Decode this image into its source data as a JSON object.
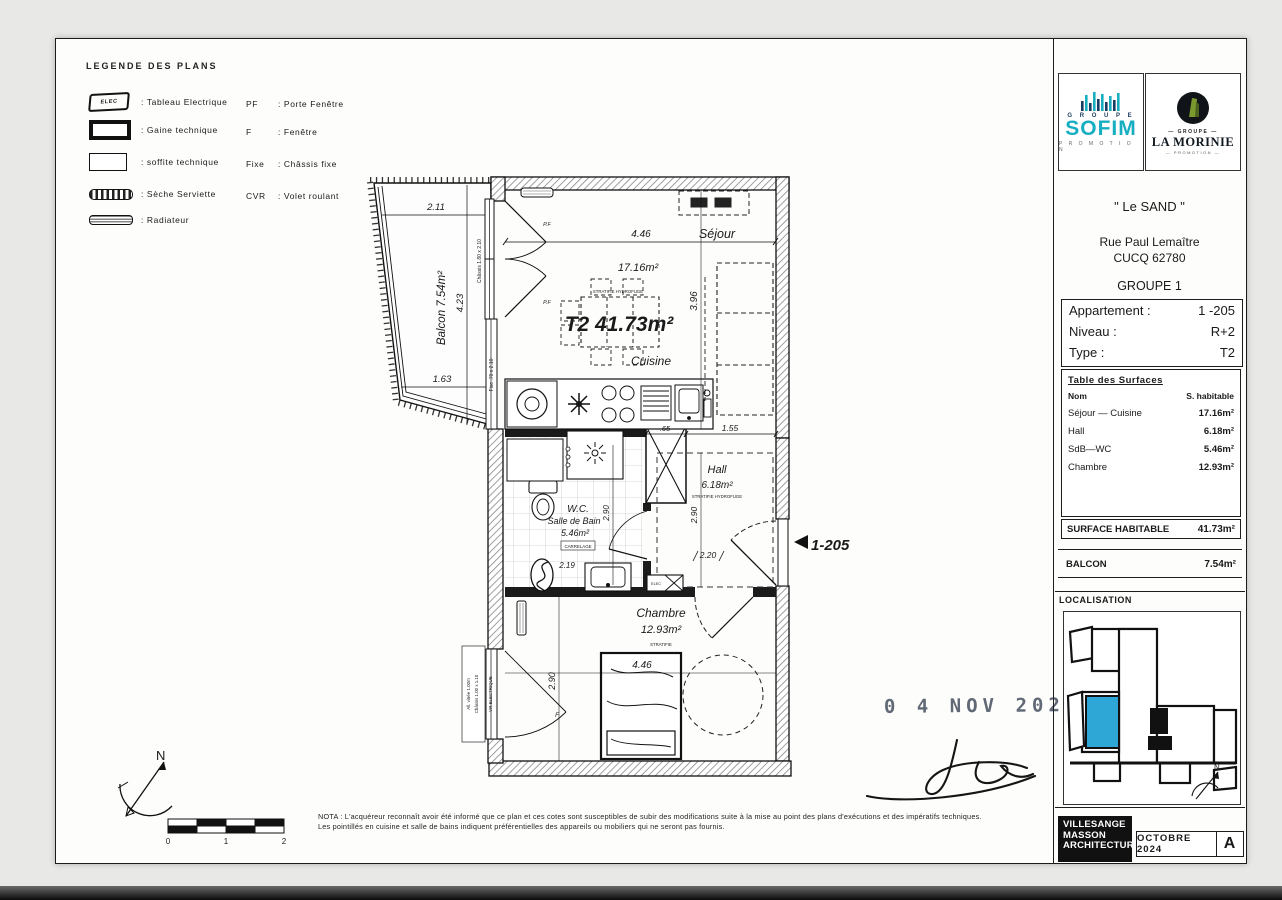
{
  "page": {
    "stamp_date": "0 4 NOV  2024",
    "nota_line1": "NOTA : L'acquéreur reconnaît avoir été informé que ce plan et ces cotes sont susceptibles de subir des modifications suite à la mise au point des plans d'exécutions et des impératifs techniques.",
    "nota_line2": "Les pointillés en cuisine et salle de bains indiquent préférentielles des appareils ou mobiliers qui ne seront pas fournis.",
    "scale": {
      "s0": "0",
      "s1": "1",
      "s2": "2"
    },
    "compass_n": "N"
  },
  "legend": {
    "title": "LEGENDE  DES  PLANS",
    "elec_label": "ELEC",
    "items": [
      {
        "label": ":  Tableau  Electrique"
      },
      {
        "label": ":  Gaine  technique"
      },
      {
        "label": ":  soffite  technique"
      },
      {
        "label": ":  Sèche  Serviette"
      },
      {
        "label": ":  Radiateur"
      }
    ],
    "abbrevs": [
      {
        "abbr": "PF",
        "label": ":  Porte  Fenêtre"
      },
      {
        "abbr": "F",
        "label": ":  Fenêtre"
      },
      {
        "abbr": "Fixe",
        "label": ":  Châssis  fixe"
      },
      {
        "abbr": "CVR",
        "label": ":  Volet  roulant"
      }
    ]
  },
  "title_block": {
    "sofim": {
      "group": "G R O U P E",
      "brand": "SOFIM",
      "sub": "P R O M O T I O N"
    },
    "morinie": {
      "group": "— GROUPE —",
      "brand": "LA MORINIE",
      "sub": "— PROMOTION —"
    },
    "project": "\" Le  SAND \"",
    "address1": "Rue  Paul  Lemaître",
    "address2": "CUCQ   62780",
    "group": "GROUPE 1",
    "info": {
      "apartment_label": "Appartement :",
      "apartment_value": "1 -205",
      "level_label": "Niveau :",
      "level_value": "R+2",
      "type_label": "Type :",
      "type_value": "T2"
    },
    "surfaces": {
      "title": "Table  des  Surfaces",
      "col_name": "Nom",
      "col_value": "S.  habitable",
      "rows": [
        {
          "name": "Séjour  —  Cuisine",
          "value": "17.16m²"
        },
        {
          "name": "Hall",
          "value": "6.18m²"
        },
        {
          "name": "SdB—WC",
          "value": "5.46m²"
        },
        {
          "name": "Chambre",
          "value": "12.93m²"
        }
      ]
    },
    "surface_habitable_label": "SURFACE  HABITABLE",
    "surface_habitable_value": "41.73m²",
    "balcon_label": "BALCON",
    "balcon_value": "7.54m²",
    "localisation_title": "LOCALISATION",
    "architect_line1": "VILLESANGE",
    "architect_line2": "MASSON",
    "architect_line3": "ARCHITECTURE",
    "date_box": "OCTOBRE  2024",
    "revision": "A",
    "map_north": "N",
    "colors": {
      "sofim_teal": "#18aec2",
      "sofim_navy": "#1d3b5e",
      "highlight_blue": "#2ea7d6"
    }
  },
  "plan": {
    "big_label": "T2 41.73m²",
    "entrance_label": "1-205",
    "sejour": {
      "name": "Séjour",
      "area": "17.16m²",
      "floor_note": "STRATIFIE HYDROFUGE",
      "dim_w": "4.46",
      "dim_h": "3.96"
    },
    "cuisine": {
      "name": "Cuisine"
    },
    "balcon": {
      "label": "Balcon 7.54m²",
      "dim_top": "2.11",
      "dim_side": "4.23",
      "dim_bottom": "1.63"
    },
    "sdb": {
      "line1": "W.C.",
      "line2": "Salle de Bain",
      "area": "5.46m²",
      "floor_note": "CARRELAGE",
      "dim_w": "2.19",
      "dim_h": "2.90"
    },
    "hall": {
      "name": "Hall",
      "area": "6.18m²",
      "floor_note": "STRATIFIE HYDROFUGE",
      "dim_h": "2.90",
      "dim_w": "1.55",
      "dim_entry": "2.20"
    },
    "gaine_dim": ".65",
    "chambre": {
      "name": "Chambre",
      "area": "12.93m²",
      "floor_note": "STRATIFIE",
      "dim_w": "4.46",
      "dim_h": "2.90"
    },
    "labels": {
      "pf1": "P.F",
      "pf2": "P.F",
      "f": "F",
      "chassis_sejour": "Châssis 1.80 x 2.10",
      "fixe_note": "Fixe .70 x 2.10",
      "chassis_chambre": "Châssis 1.00 x 1.10",
      "allege": "All. vitrée 1.00m",
      "vr": "VR ELECTRIQUE",
      "elec": "ELEC"
    }
  }
}
